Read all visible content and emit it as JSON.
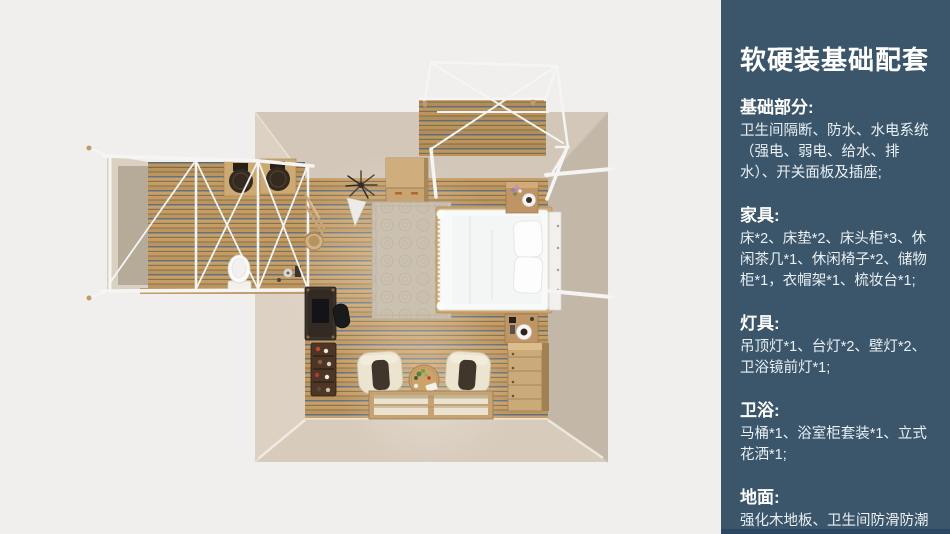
{
  "palette": {
    "background": "#f0efee",
    "sidebar_bg": "#3b566b",
    "sidebar_bottom_strip": "#2a4660",
    "sidebar_text": "#ffffff",
    "wall_beige": "#d2c7b8",
    "wall_light": "#dcd1c2",
    "wood_floor": "#c49c65",
    "wood_dark_line": "#8b7048",
    "wood_blue_line": "#64727f",
    "furniture_wood": "#c9a672",
    "bed_white": "#f8f9f9",
    "frame_white": "#f5f5f3",
    "cushion_dark": "#40362b"
  },
  "sidebar": {
    "title": "软硬装基础配套",
    "sections": [
      {
        "heading": "基础部分:",
        "body": "卫生间隔断、防水、水电系统（强电、弱电、给水、排水）、开关面板及插座;"
      },
      {
        "heading": "家具:",
        "body": "床*2、床垫*2、床头柜*3、休闲茶几*1、休闲椅子*2、储物柜*1，衣帽架*1、梳妆台*1;"
      },
      {
        "heading": "灯具:",
        "body": "吊顶灯*1、台灯*2、壁灯*2、卫浴镜前灯*1;"
      },
      {
        "heading": "卫浴:",
        "body": "马桶*1、浴室柜套装*1、立式花洒*1;"
      },
      {
        "heading": "地面:",
        "body": "强化木地板、卫生间防滑防潮石塑板;"
      }
    ]
  },
  "floorplan": {
    "view": "top-down 3D render",
    "rooms": [
      "bedroom",
      "bathroom-annex",
      "balcony-deck"
    ],
    "furniture": [
      "bed",
      "rug",
      "storage-cabinet",
      "nightstand-top",
      "nightstand-bottom",
      "desk",
      "desk-chair",
      "shoe-rack",
      "clothes-rack",
      "basket",
      "plant",
      "armchair-left",
      "armchair-right",
      "tea-table",
      "floor-mats",
      "dresser",
      "vanity-sinks",
      "toilet",
      "shower-set",
      "canopy-frame"
    ]
  }
}
